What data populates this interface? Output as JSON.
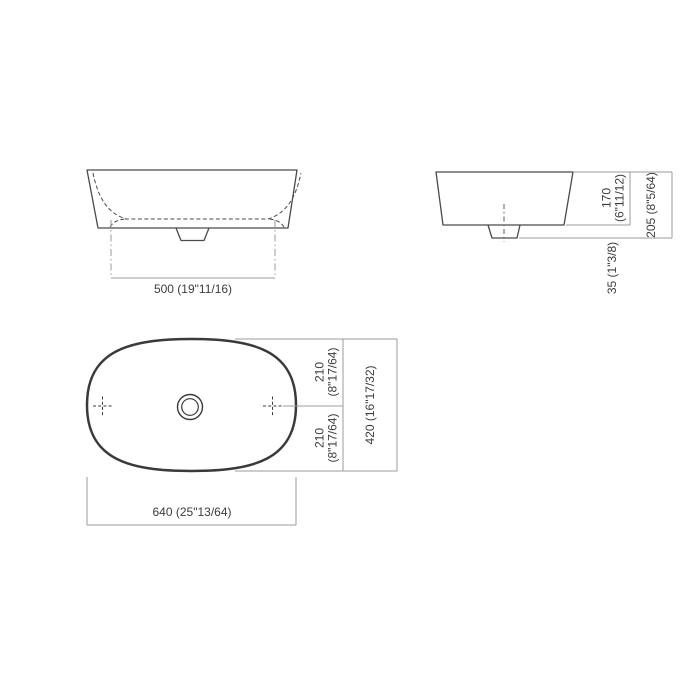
{
  "colors": {
    "background": "#ffffff",
    "part_outline": "#4a4a4a",
    "plan_outline": "#3a3a3a",
    "dimension_lines": "#9b9b9b",
    "text": "#3c3c3c"
  },
  "front_view": {
    "width_label": "500 (19\"11/16)"
  },
  "side_view": {
    "rim_height_mm": "170",
    "rim_height_in": "(6\"11/12)",
    "total_height_label": "205 (8\"5/64)",
    "drain_height_label": "35 (1\"3/8)"
  },
  "plan_view": {
    "upper_half_mm": "210",
    "upper_half_in": "(8\"17/64)",
    "lower_half_mm": "210",
    "lower_half_in": "(8\"17/64)",
    "depth_label": "420 (16\"17/32)",
    "width_label": "640 (25\"13/64)"
  }
}
